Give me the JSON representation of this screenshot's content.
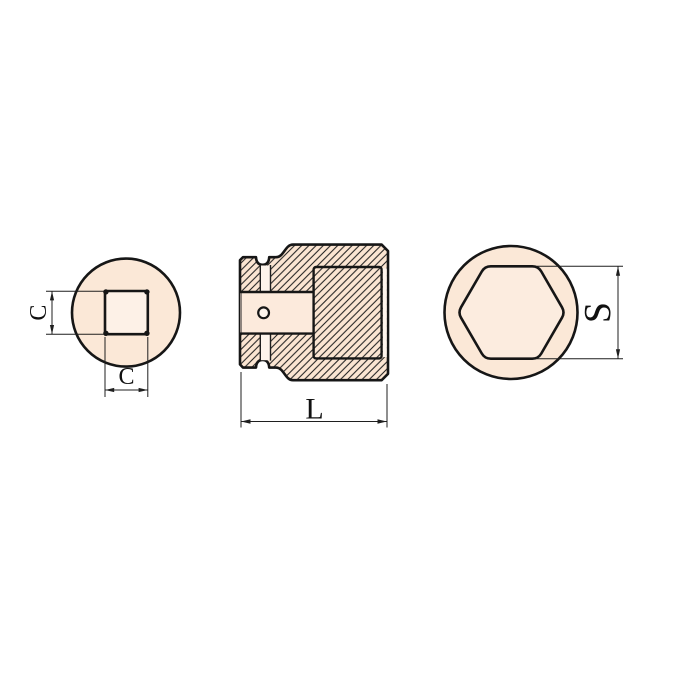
{
  "views": {
    "square_drive_end": {
      "dim_height_label": "C",
      "dim_width_label": "C"
    },
    "section": {
      "dim_length_label": "L"
    },
    "hex_opening": {
      "dim_across_flats_label": "S"
    }
  },
  "colors": {
    "background": "#ffffff",
    "line": "#161616",
    "part_tint": "#fbe5d2",
    "face_fill": "#fbe8d7",
    "recess_fill": "#fdf1e7",
    "hex_fill": "#fcecdf",
    "hole_fill": "#fceadc",
    "hole_highlight": "#fdf4ec"
  }
}
